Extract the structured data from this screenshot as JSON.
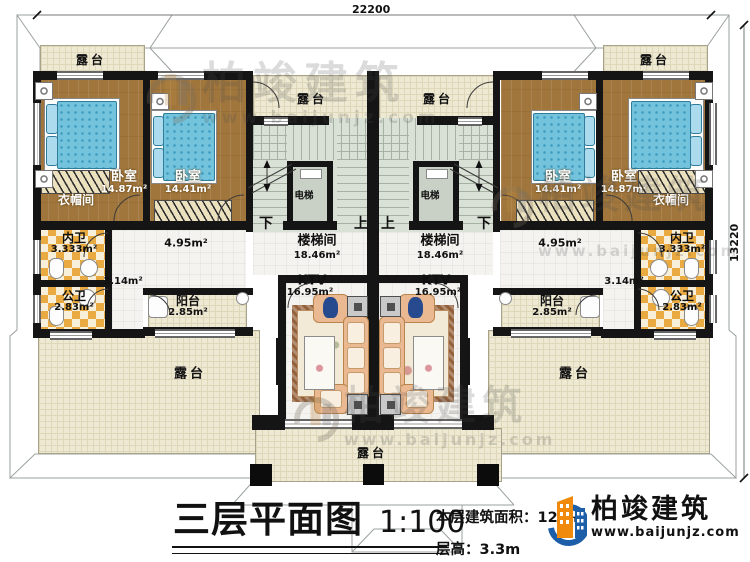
{
  "dimensions": {
    "top_width": "22200",
    "right_height": "13220"
  },
  "labels": {
    "terrace": "露台",
    "bedroom": "卧室",
    "area_bedroom_outer": "14.87m²",
    "area_bedroom_inner": "14.41m²",
    "cloakroom": "衣帽间",
    "inner_bath": "内卫",
    "area_inner_bath": "3.333m²",
    "public_bath": "公卫",
    "area_public_bath": "2.83m²",
    "area_corridor": "3.14m²",
    "area_hall": "4.95m²",
    "balcony": "阳台",
    "area_balcony": "2.85m²",
    "stairwell": "楼梯间",
    "area_stairwell": "18.46m²",
    "elevator": "电梯",
    "up": "上",
    "down": "下",
    "ktv": "KTV",
    "area_ktv": "16.95m²"
  },
  "title": {
    "name": "三层平面图",
    "scale": "1:100"
  },
  "info": {
    "area_label": "本层建筑面积：",
    "area_value_visible": "12",
    "area_unit": "m²",
    "floor_height_label": "层高：",
    "floor_height_value": "3.3m"
  },
  "brand": {
    "name": "柏竣建筑",
    "website": "www.baijunjz.com"
  }
}
